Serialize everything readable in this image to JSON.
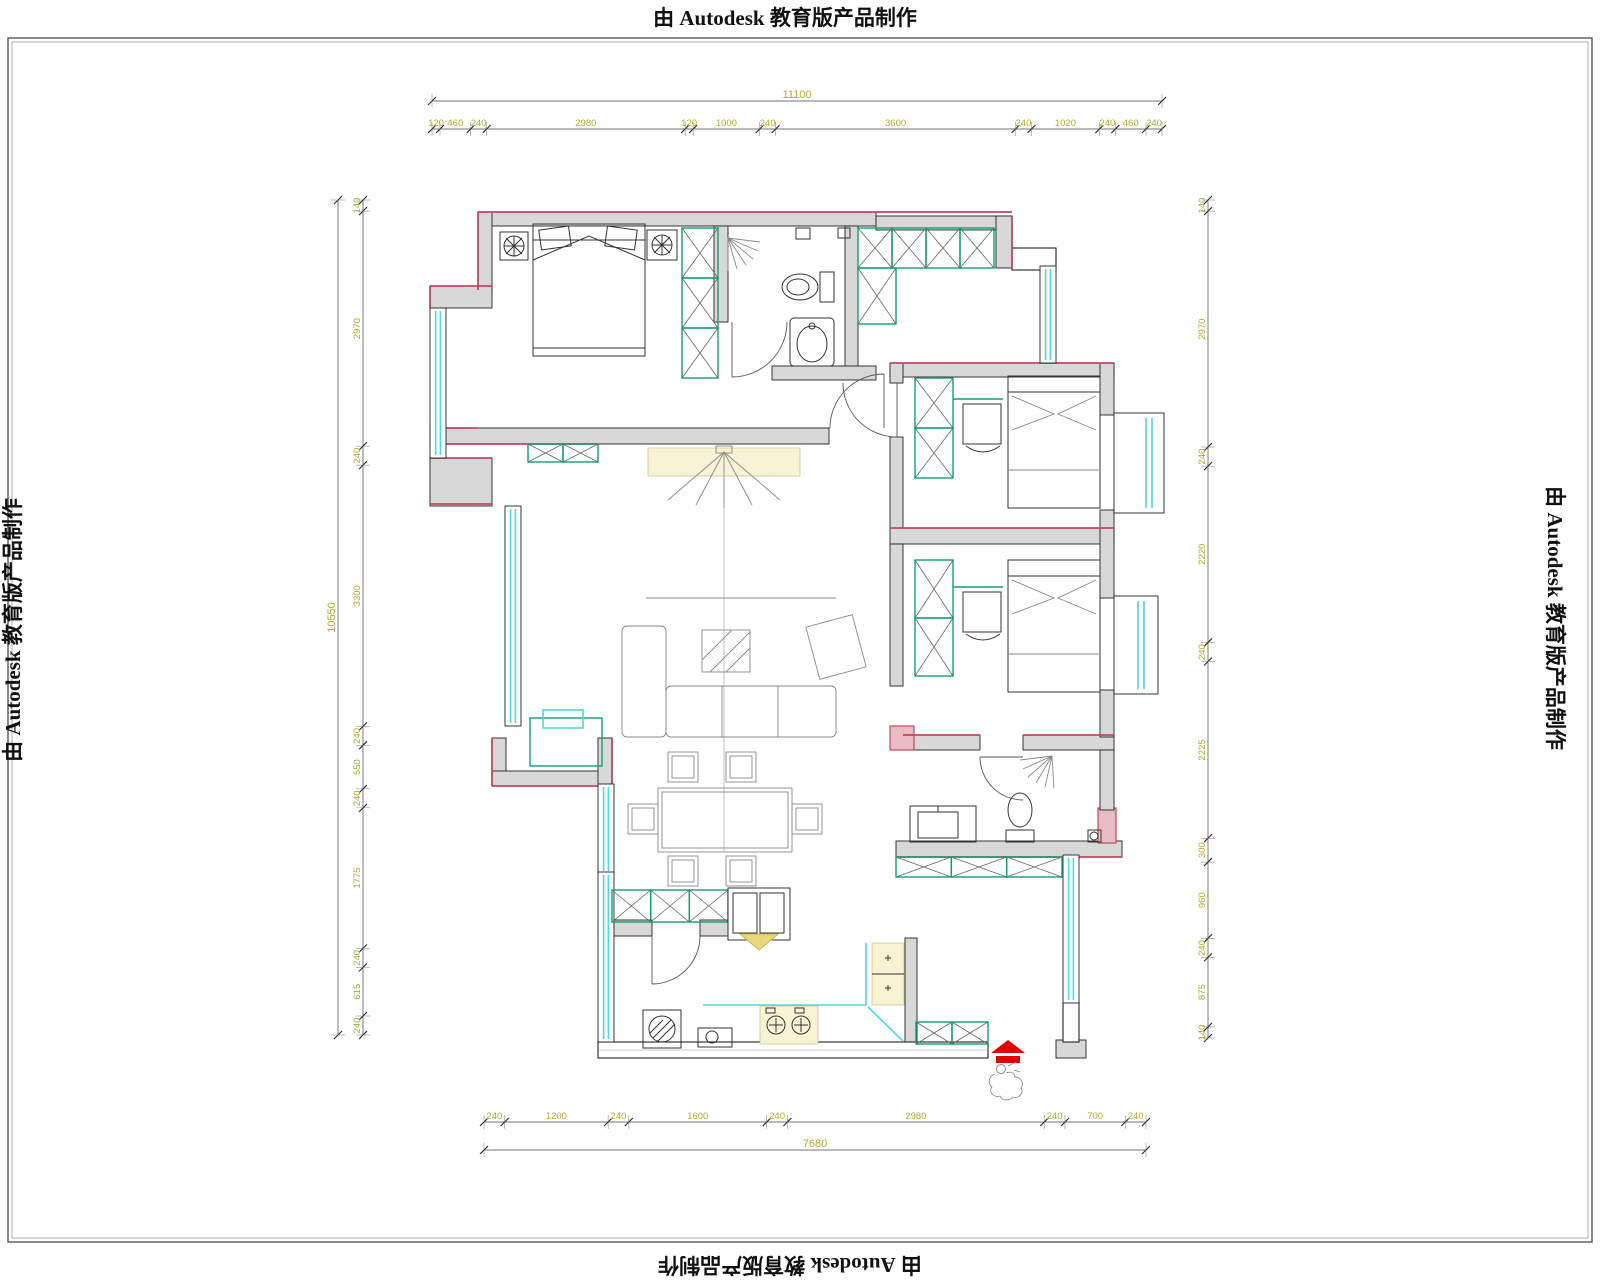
{
  "watermarks": {
    "top": "由 Autodesk 教育版产品制作",
    "bottom": "由 Autodesk 教育版产品制作",
    "left": "由 Autodesk 教育版产品制作",
    "right": "由 Autodesk 教育版产品制作"
  },
  "colors": {
    "wall_fill": "#d8d8d8",
    "wall_accent_red": "#c2485e",
    "pink_block": "#e9bcc4",
    "window_glass": "#4fd9d9",
    "cabinet_teal": "#12a071",
    "dimension_text": "#b3a92c",
    "highlight_yellow": "#f7f3d4",
    "entry_arrow_red": "#e10000"
  },
  "dimensions": {
    "top_total": "11100",
    "top_segments": [
      "120",
      "460",
      "240",
      "2980",
      "120",
      "1000",
      "240",
      "3600",
      "240",
      "1020",
      "240",
      "460",
      "240"
    ],
    "bottom_segments": [
      "240",
      "1200",
      "240",
      "1600",
      "240",
      "2980",
      "240",
      "700",
      "240"
    ],
    "bottom_total": "7680",
    "left_total": "10550",
    "left_segments": [
      "140",
      "2970",
      "240",
      "3300",
      "240",
      "550",
      "240",
      "1775",
      "240",
      "615",
      "240"
    ],
    "right_segments": [
      "140",
      "2970",
      "240",
      "2220",
      "240",
      "2225",
      "300",
      "960",
      "240",
      "875",
      "140"
    ]
  }
}
